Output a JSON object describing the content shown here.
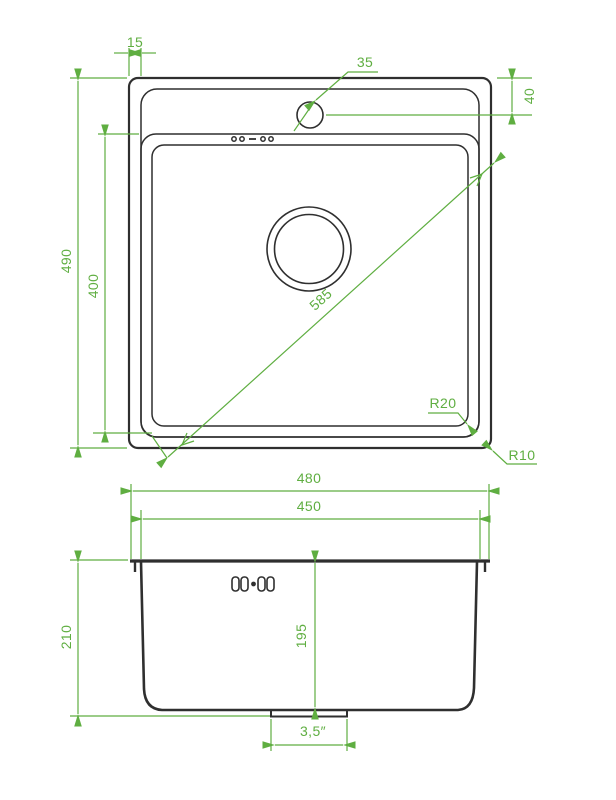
{
  "drawing": {
    "title": "sink-dimension-drawing",
    "background_color": "#ffffff",
    "outline_color": "#2f2f2f",
    "dimension_color": "#5fae41"
  },
  "top_view": {
    "labels": {
      "rim_width": "15",
      "overall_height": "490",
      "bowl_height": "400",
      "faucet_hole_diameter": "35",
      "faucet_hole_offset": "40",
      "bowl_diagonal": "585",
      "bowl_corner_radius": "R20",
      "outer_corner_radius": "R10"
    }
  },
  "width_dims": {
    "overall_width": "480",
    "bowl_width": "450"
  },
  "side_view": {
    "labels": {
      "overall_depth": "210",
      "bowl_depth": "195",
      "drain_diameter": "3,5″"
    }
  }
}
